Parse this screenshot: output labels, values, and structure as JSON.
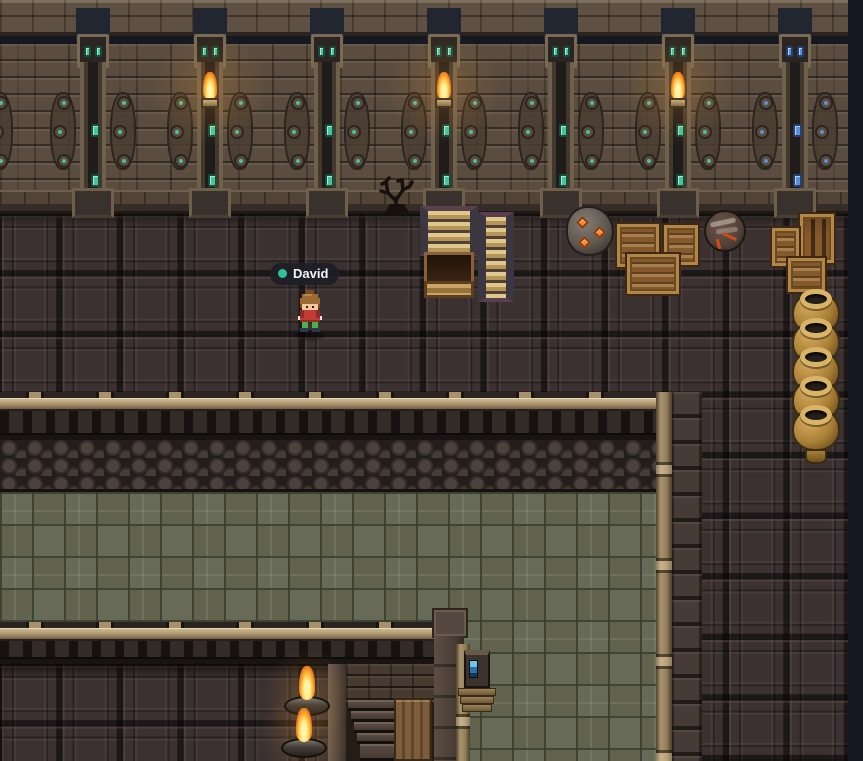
{
  "ui": {
    "player_nametag": {
      "label": "David",
      "presence_dot_color": "#2fc19a",
      "bg_color": "#1e1f25",
      "text_color": "#f4f4f6"
    }
  },
  "palette": {
    "backdrop": "#151820",
    "wall_brick": "#5a4d40",
    "floor_panel": "#3a3130",
    "cobblestone": "#352d2a",
    "pit_floor_green": "#666a56",
    "gem_teal": "#49c39b",
    "gem_blue": "#5b8fd9",
    "flame_orange": "#f07f1d",
    "wood_tan": "#a8946c",
    "crate_brown": "#84592c",
    "pot_gold": "#c89a4e",
    "device_screen_blue": "#6ec4ee"
  },
  "scene": {
    "pillars": [
      {
        "cx": 93,
        "torch": false,
        "gems": "teal"
      },
      {
        "cx": 210,
        "torch": true,
        "gems": "teal"
      },
      {
        "cx": 327,
        "torch": false,
        "gems": "teal"
      },
      {
        "cx": 444,
        "torch": true,
        "gems": "teal"
      },
      {
        "cx": 561,
        "torch": false,
        "gems": "teal"
      },
      {
        "cx": 678,
        "torch": true,
        "gems": "teal"
      },
      {
        "cx": 795,
        "torch": false,
        "gems": "blue"
      }
    ],
    "edge_wing_x": -13,
    "crates": [
      {
        "x": 615,
        "y": 222,
        "w": 46,
        "h": 47,
        "style": "plain"
      },
      {
        "x": 662,
        "y": 223,
        "w": 38,
        "h": 44,
        "style": "plain"
      },
      {
        "x": 625,
        "y": 252,
        "w": 56,
        "h": 44,
        "style": "plain"
      },
      {
        "x": 798,
        "y": 212,
        "w": 38,
        "h": 53,
        "style": "slats"
      },
      {
        "x": 770,
        "y": 226,
        "w": 31,
        "h": 42,
        "style": "plain"
      },
      {
        "x": 786,
        "y": 256,
        "w": 41,
        "h": 38,
        "style": "plain"
      }
    ],
    "pot_stack": {
      "x": 792,
      "y": 291,
      "count": 5,
      "spacing": 29
    },
    "sconces": [
      {
        "x": 284,
        "y": 666
      },
      {
        "x": 281,
        "y": 708
      }
    ],
    "player": {
      "x": 292,
      "y": 288
    },
    "nametag_pos": {
      "x": 270,
      "y": 263
    }
  }
}
